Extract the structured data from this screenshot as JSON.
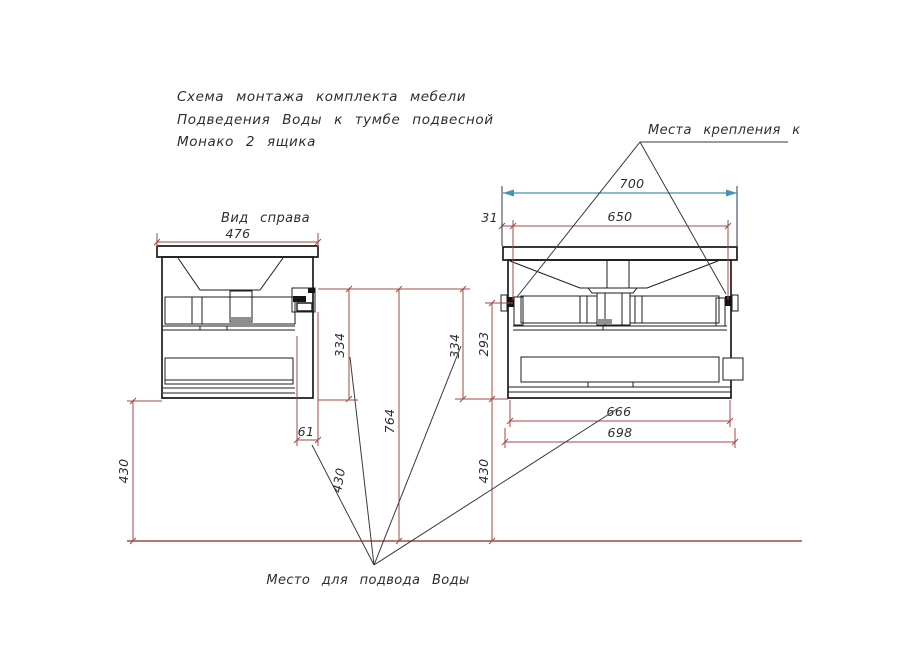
{
  "title": {
    "line1": "Схема монтажа комплекта мебели",
    "line2": "Подведения Воды к тумбе подвесной",
    "line3": "Монако 2 ящика"
  },
  "views": {
    "side_label": "Вид справа"
  },
  "annotations": {
    "mounting": "Места крепления к",
    "water": "Место для подвода Воды"
  },
  "dims": {
    "side_width": "476",
    "floor_left": "430",
    "inlet_offset": "61",
    "side_bracket_drop": "334",
    "total_height": "764",
    "inlet_height": "430",
    "front_bracket_drop": "334",
    "drawer_zone": "293",
    "floor_right": "430",
    "overall_width": "700",
    "bracket_span": "650",
    "edge_offset": "31",
    "inner_width": "666",
    "body_width": "698"
  },
  "colors": {
    "dimension_red": "#a34848",
    "accent_blue": "#4691b4",
    "drawing_black": "#1c1c1c"
  }
}
